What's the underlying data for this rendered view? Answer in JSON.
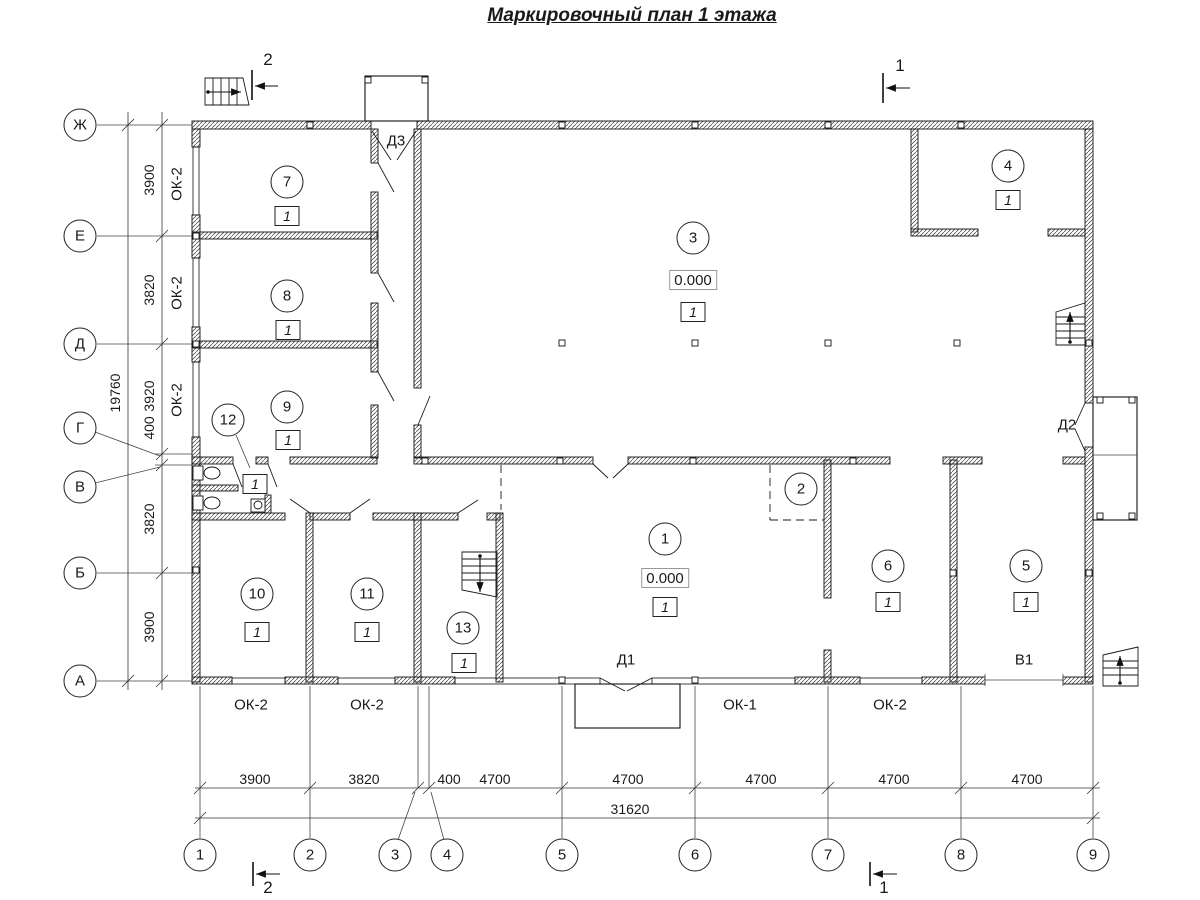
{
  "title": "Маркировочный план 1 этажа",
  "colors": {
    "line": "#1a1a1a",
    "background": "#ffffff"
  },
  "axes_left": {
    "cx": 80,
    "items": [
      {
        "label": "Ж",
        "y": 125
      },
      {
        "label": "Е",
        "y": 236
      },
      {
        "label": "Д",
        "y": 344
      },
      {
        "label": "Г",
        "y": 428
      },
      {
        "label": "В",
        "y": 487
      },
      {
        "label": "Б",
        "y": 573
      },
      {
        "label": "А",
        "y": 681
      }
    ]
  },
  "axes_bottom": {
    "cy": 855,
    "items": [
      {
        "label": "1",
        "x": 200
      },
      {
        "label": "2",
        "x": 310
      },
      {
        "label": "3",
        "x": 395
      },
      {
        "label": "4",
        "x": 447
      },
      {
        "label": "5",
        "x": 562
      },
      {
        "label": "6",
        "x": 695
      },
      {
        "label": "7",
        "x": 828
      },
      {
        "label": "8",
        "x": 961
      },
      {
        "label": "9",
        "x": 1093
      }
    ]
  },
  "dims_left": {
    "lines": [
      {
        "x": 162,
        "lx": 149,
        "y1": 112,
        "y2": 690,
        "ticks": [
          125,
          236,
          344,
          454,
          465,
          573,
          681
        ],
        "labels": [
          {
            "v": "3900",
            "y": 180
          },
          {
            "v": "3820",
            "y": 290
          },
          {
            "v": "3920",
            "y": 396
          },
          {
            "v": "400",
            "y": 428
          },
          {
            "v": "3820",
            "y": 519
          },
          {
            "v": "3900",
            "y": 627
          }
        ]
      },
      {
        "x": 128,
        "lx": 115,
        "y1": 112,
        "y2": 690,
        "ticks": [
          125,
          681
        ],
        "labels": [
          {
            "v": "19760",
            "y": 393
          }
        ]
      }
    ]
  },
  "dims_bottom": {
    "lines": [
      {
        "y": 788,
        "ly": 779,
        "x1": 195,
        "x2": 1100,
        "ticks": [
          200,
          310,
          418,
          429,
          562,
          695,
          828,
          961,
          1093
        ],
        "labels": [
          {
            "v": "3900",
            "x": 255
          },
          {
            "v": "3820",
            "x": 364
          },
          {
            "v": "400",
            "x": 449
          },
          {
            "v": "4700",
            "x": 495
          },
          {
            "v": "4700",
            "x": 628
          },
          {
            "v": "4700",
            "x": 761
          },
          {
            "v": "4700",
            "x": 894
          },
          {
            "v": "4700",
            "x": 1027
          }
        ]
      },
      {
        "y": 818,
        "ly": 809,
        "x1": 195,
        "x2": 1100,
        "ticks": [
          200,
          1093
        ],
        "labels": [
          {
            "v": "31620",
            "x": 630
          }
        ]
      }
    ]
  },
  "rooms": [
    {
      "n": "1",
      "x": 665,
      "y": 539,
      "elev": {
        "v": "0.000",
        "x": 665,
        "y": 578
      },
      "sq": {
        "v": "1",
        "x": 665,
        "y": 607
      }
    },
    {
      "n": "2",
      "x": 801,
      "y": 489
    },
    {
      "n": "3",
      "x": 693,
      "y": 238,
      "elev": {
        "v": "0.000",
        "x": 693,
        "y": 280
      },
      "sq": {
        "v": "1",
        "x": 693,
        "y": 312
      }
    },
    {
      "n": "4",
      "x": 1008,
      "y": 166,
      "sq": {
        "v": "1",
        "x": 1008,
        "y": 200
      }
    },
    {
      "n": "5",
      "x": 1026,
      "y": 566,
      "sq": {
        "v": "1",
        "x": 1026,
        "y": 602
      }
    },
    {
      "n": "6",
      "x": 888,
      "y": 566,
      "sq": {
        "v": "1",
        "x": 888,
        "y": 602
      }
    },
    {
      "n": "7",
      "x": 287,
      "y": 182,
      "sq": {
        "v": "1",
        "x": 287,
        "y": 216
      }
    },
    {
      "n": "8",
      "x": 287,
      "y": 296,
      "sq": {
        "v": "1",
        "x": 288,
        "y": 330
      }
    },
    {
      "n": "9",
      "x": 287,
      "y": 407,
      "sq": {
        "v": "1",
        "x": 288,
        "y": 440
      }
    },
    {
      "n": "10",
      "x": 257,
      "y": 594,
      "sq": {
        "v": "1",
        "x": 257,
        "y": 632
      }
    },
    {
      "n": "11",
      "x": 367,
      "y": 594,
      "sq": {
        "v": "1",
        "x": 367,
        "y": 632
      }
    },
    {
      "n": "12",
      "x": 228,
      "y": 420,
      "sq": {
        "v": "1",
        "x": 255,
        "y": 484
      }
    },
    {
      "n": "13",
      "x": 463,
      "y": 628,
      "sq": {
        "v": "1",
        "x": 464,
        "y": 663
      }
    }
  ],
  "window_tags": [
    {
      "text": "ОК-2",
      "x": 177,
      "y": 184,
      "rot": true
    },
    {
      "text": "ОК-2",
      "x": 177,
      "y": 293,
      "rot": true
    },
    {
      "text": "ОК-2",
      "x": 177,
      "y": 400,
      "rot": true
    },
    {
      "text": "ОК-2",
      "x": 251,
      "y": 705
    },
    {
      "text": "ОК-2",
      "x": 367,
      "y": 705
    },
    {
      "text": "ОК-1",
      "x": 740,
      "y": 705
    },
    {
      "text": "ОК-2",
      "x": 890,
      "y": 705
    }
  ],
  "door_tags": [
    {
      "text": "Д3",
      "x": 396,
      "y": 141
    },
    {
      "text": "Д1",
      "x": 626,
      "y": 660
    },
    {
      "text": "Д2",
      "x": 1067,
      "y": 425
    },
    {
      "text": "В1",
      "x": 1024,
      "y": 660
    }
  ],
  "section_marks": [
    {
      "label": "1",
      "lx": 900,
      "ly": 66,
      "bar": [
        883,
        73,
        883,
        103
      ],
      "arrow": [
        910,
        88,
        886,
        88
      ]
    },
    {
      "label": "2",
      "lx": 268,
      "ly": 60,
      "bar": [
        252,
        70,
        252,
        100
      ],
      "arrow": [
        278,
        86,
        255,
        86
      ]
    },
    {
      "label": "1",
      "lx": 884,
      "ly": 888,
      "bar": [
        870,
        862,
        870,
        886
      ],
      "arrow": [
        897,
        874,
        873,
        874
      ]
    },
    {
      "label": "2",
      "lx": 268,
      "ly": 888,
      "bar": [
        253,
        862,
        253,
        886
      ],
      "arrow": [
        280,
        874,
        256,
        874
      ]
    }
  ],
  "geometry": {
    "walls": [
      [
        192,
        121,
        179,
        8
      ],
      [
        417,
        121,
        676,
        8
      ],
      [
        192,
        129,
        8,
        18
      ],
      [
        192,
        215,
        8,
        43
      ],
      [
        192,
        327,
        8,
        35
      ],
      [
        192,
        437,
        8,
        245
      ],
      [
        1085,
        129,
        8,
        274
      ],
      [
        1085,
        447,
        8,
        235
      ],
      [
        192,
        232,
        185,
        7
      ],
      [
        192,
        341,
        185,
        7
      ],
      [
        371,
        129,
        7,
        34
      ],
      [
        371,
        192,
        7,
        81
      ],
      [
        371,
        303,
        7,
        69
      ],
      [
        371,
        405,
        7,
        53
      ],
      [
        414,
        129,
        7,
        259
      ],
      [
        414,
        425,
        7,
        33
      ],
      [
        192,
        457,
        41,
        7
      ],
      [
        256,
        457,
        12,
        7
      ],
      [
        290,
        457,
        87,
        7
      ],
      [
        414,
        457,
        179,
        7
      ],
      [
        628,
        457,
        262,
        7
      ],
      [
        943,
        457,
        39,
        7
      ],
      [
        1063,
        457,
        22,
        7
      ],
      [
        192,
        485,
        46,
        6
      ],
      [
        192,
        513,
        93,
        7
      ],
      [
        310,
        513,
        40,
        7
      ],
      [
        373,
        513,
        85,
        7
      ],
      [
        487,
        513,
        13,
        7
      ],
      [
        265,
        495,
        6,
        18
      ],
      [
        306,
        513,
        7,
        169
      ],
      [
        414,
        513,
        7,
        169
      ],
      [
        496,
        513,
        7,
        169
      ],
      [
        824,
        460,
        7,
        138
      ],
      [
        824,
        650,
        7,
        32
      ],
      [
        950,
        460,
        7,
        222
      ],
      [
        911,
        129,
        7,
        103
      ],
      [
        911,
        229,
        67,
        7
      ],
      [
        1048,
        229,
        37,
        7
      ],
      [
        192,
        677,
        40,
        7
      ],
      [
        285,
        677,
        53,
        7
      ],
      [
        395,
        677,
        60,
        7
      ],
      [
        795,
        677,
        65,
        7
      ],
      [
        922,
        677,
        63,
        7
      ],
      [
        1063,
        677,
        30,
        7
      ]
    ],
    "windows": [
      [
        193,
        147,
        6,
        68
      ],
      [
        193,
        258,
        6,
        69
      ],
      [
        193,
        362,
        6,
        75
      ],
      [
        232,
        678,
        53,
        6
      ],
      [
        338,
        678,
        57,
        6
      ],
      [
        455,
        678,
        145,
        6
      ],
      [
        652,
        678,
        143,
        6
      ],
      [
        860,
        678,
        62,
        6
      ]
    ],
    "porches": [
      [
        365,
        76,
        63,
        45
      ],
      [
        575,
        684,
        105,
        44
      ],
      [
        1093,
        397,
        44,
        123
      ]
    ],
    "thin": [
      [
        200,
        686,
        200,
        838
      ],
      [
        310,
        686,
        310,
        838
      ],
      [
        562,
        686,
        562,
        838
      ],
      [
        695,
        686,
        695,
        838
      ],
      [
        828,
        686,
        828,
        838
      ],
      [
        961,
        686,
        961,
        838
      ],
      [
        1093,
        686,
        1093,
        838
      ],
      [
        418,
        686,
        418,
        788
      ],
      [
        429,
        686,
        429,
        788
      ],
      [
        398,
        840,
        415,
        792
      ],
      [
        444,
        840,
        431,
        792
      ],
      [
        97,
        125,
        192,
        125
      ],
      [
        97,
        236,
        192,
        236
      ],
      [
        97,
        344,
        192,
        344
      ],
      [
        97,
        573,
        192,
        573
      ],
      [
        97,
        681,
        192,
        681
      ],
      [
        155,
        454,
        192,
        454
      ],
      [
        155,
        465,
        192,
        465
      ],
      [
        95,
        432,
        160,
        456
      ],
      [
        95,
        483,
        160,
        467
      ],
      [
        236,
        435,
        250,
        468
      ],
      [
        1093,
        455,
        1137,
        455
      ],
      [
        985,
        674,
        985,
        686
      ],
      [
        1063,
        674,
        1063,
        686
      ],
      [
        985,
        680,
        1063,
        680
      ]
    ],
    "dash": [
      [
        501,
        465,
        501,
        510
      ],
      [
        770,
        465,
        770,
        520
      ],
      [
        770,
        520,
        824,
        520
      ]
    ],
    "leaves": [
      [
        372,
        131,
        391,
        160
      ],
      [
        416,
        131,
        397,
        160
      ],
      [
        378,
        163,
        394,
        192
      ],
      [
        378,
        273,
        394,
        302
      ],
      [
        378,
        372,
        394,
        401
      ],
      [
        418,
        425,
        430,
        396
      ],
      [
        593,
        464,
        608,
        478
      ],
      [
        628,
        464,
        613,
        478
      ],
      [
        233,
        464,
        242,
        487
      ],
      [
        268,
        464,
        277,
        487
      ],
      [
        310,
        513,
        290,
        499
      ],
      [
        350,
        513,
        370,
        499
      ],
      [
        458,
        513,
        478,
        500
      ],
      [
        600,
        678,
        625,
        691
      ],
      [
        652,
        678,
        627,
        691
      ],
      [
        1085,
        403,
        1075,
        425
      ],
      [
        1075,
        429,
        1085,
        451
      ]
    ],
    "columns": [
      [
        310,
        125
      ],
      [
        562,
        125
      ],
      [
        695,
        125
      ],
      [
        828,
        125
      ],
      [
        961,
        125
      ],
      [
        562,
        343
      ],
      [
        695,
        343
      ],
      [
        828,
        343
      ],
      [
        957,
        343
      ],
      [
        196,
        236
      ],
      [
        196,
        344
      ],
      [
        196,
        570
      ],
      [
        1089,
        343
      ],
      [
        1089,
        573
      ],
      [
        425,
        461
      ],
      [
        560,
        461
      ],
      [
        693,
        461
      ],
      [
        853,
        461
      ],
      [
        562,
        680
      ],
      [
        695,
        680
      ],
      [
        953,
        573
      ],
      [
        368,
        80
      ],
      [
        425,
        80
      ],
      [
        1100,
        400
      ],
      [
        1132,
        400
      ],
      [
        1100,
        516
      ],
      [
        1132,
        516
      ]
    ],
    "stairs": [
      {
        "outline": "205,78 243,78 249,105 205,105",
        "treads": [
          [
            213,
            78,
            213,
            105
          ],
          [
            221,
            78,
            221,
            105
          ],
          [
            229,
            78,
            229,
            105
          ],
          [
            237,
            78,
            237,
            105
          ]
        ],
        "arrow": [
          208,
          92,
          241,
          92
        ]
      },
      {
        "outline": "1056,312 1085,303 1085,345 1056,345",
        "treads": [
          [
            1056,
            317,
            1085,
            317
          ],
          [
            1056,
            324,
            1085,
            324
          ],
          [
            1056,
            331,
            1085,
            331
          ],
          [
            1056,
            338,
            1085,
            338
          ]
        ],
        "arrow": [
          1070,
          342,
          1070,
          312
        ]
      },
      {
        "outline": "462,552 497,552 497,597 462,590",
        "treads": [
          [
            462,
            559,
            497,
            559
          ],
          [
            462,
            566,
            497,
            566
          ],
          [
            462,
            573,
            497,
            573
          ],
          [
            462,
            580,
            497,
            580
          ]
        ],
        "arrow": [
          480,
          556,
          480,
          592
        ]
      },
      {
        "outline": "1103,655 1138,647 1138,686 1103,686",
        "treads": [
          [
            1103,
            661,
            1138,
            661
          ],
          [
            1103,
            668,
            1138,
            668
          ],
          [
            1103,
            675,
            1138,
            675
          ]
        ],
        "arrow": [
          1120,
          683,
          1120,
          656
        ]
      }
    ],
    "fixtures": [
      {
        "kind": "wc",
        "tank": [
          193,
          466,
          10,
          14
        ],
        "bowl": [
          212,
          473,
          8,
          6
        ]
      },
      {
        "kind": "wc",
        "tank": [
          193,
          496,
          10,
          14
        ],
        "bowl": [
          212,
          503,
          8,
          6
        ]
      },
      {
        "kind": "sink",
        "rect": [
          251,
          499,
          14,
          13
        ],
        "circle": [
          258,
          505,
          4
        ]
      }
    ]
  }
}
